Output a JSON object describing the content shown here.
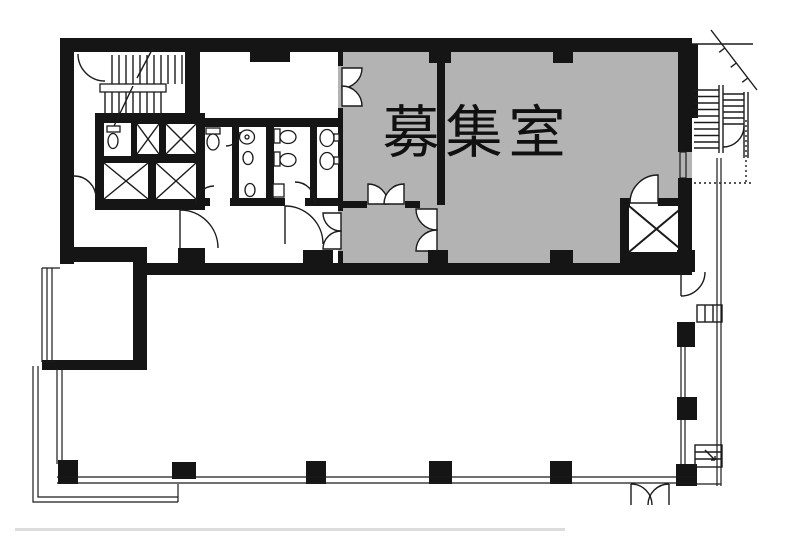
{
  "plan": {
    "room_label": "募集室",
    "colors": {
      "wall": "#151515",
      "vacant_room_fill": "#b3b3b3",
      "background": "#ffffff"
    }
  }
}
